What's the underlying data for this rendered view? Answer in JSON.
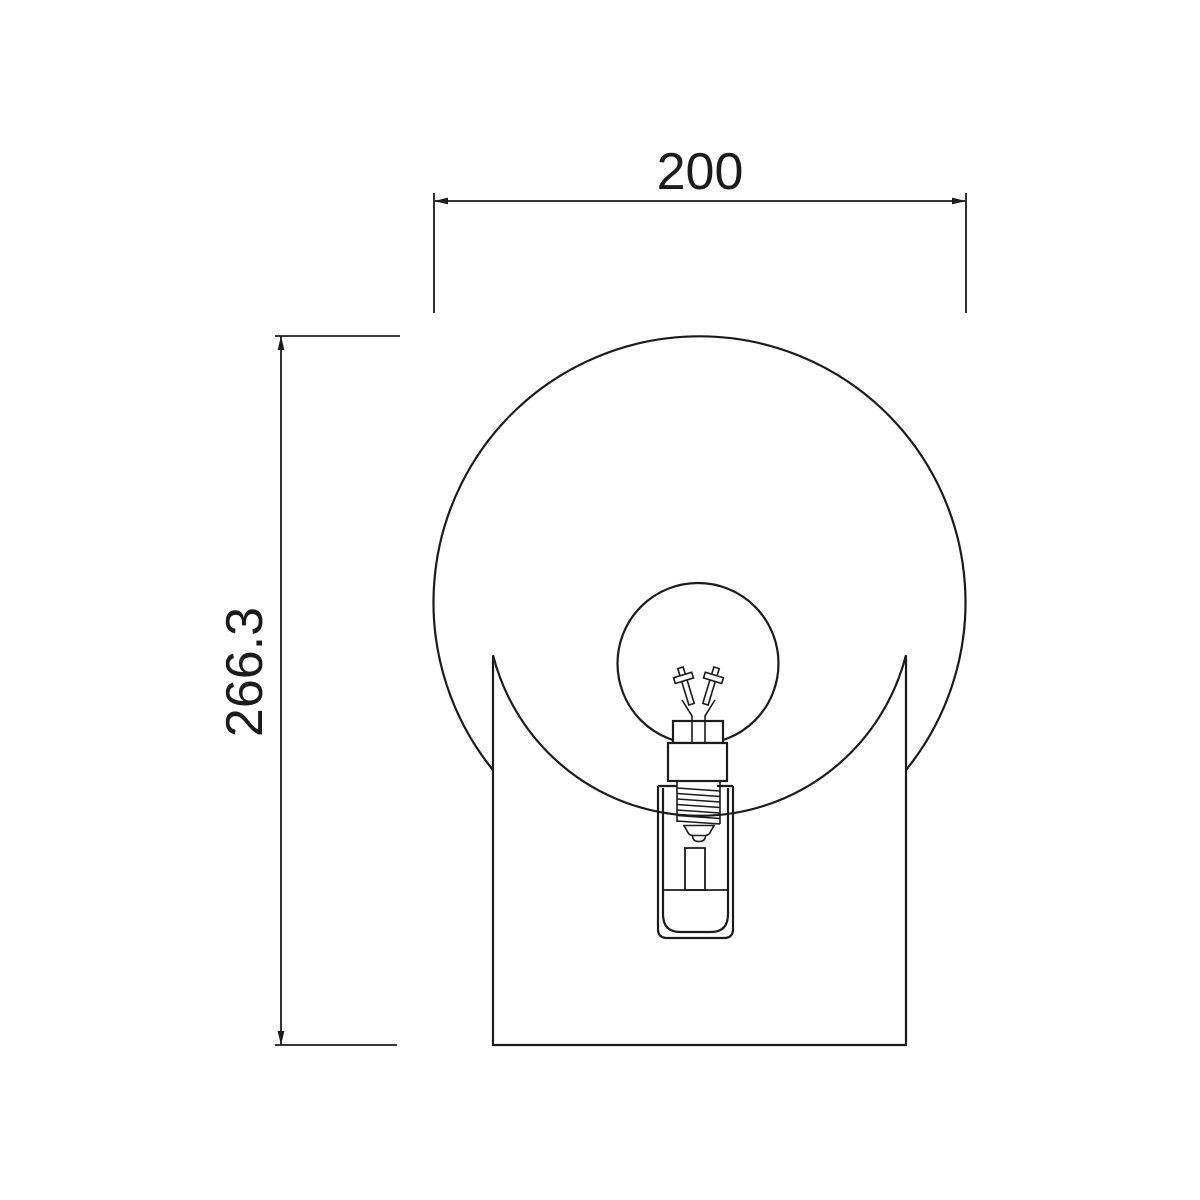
{
  "canvas": {
    "background": "#ffffff",
    "line_color": "#1b1b1b"
  },
  "dimensions": {
    "width": {
      "label": "200"
    },
    "height": {
      "label": "266.3"
    }
  }
}
